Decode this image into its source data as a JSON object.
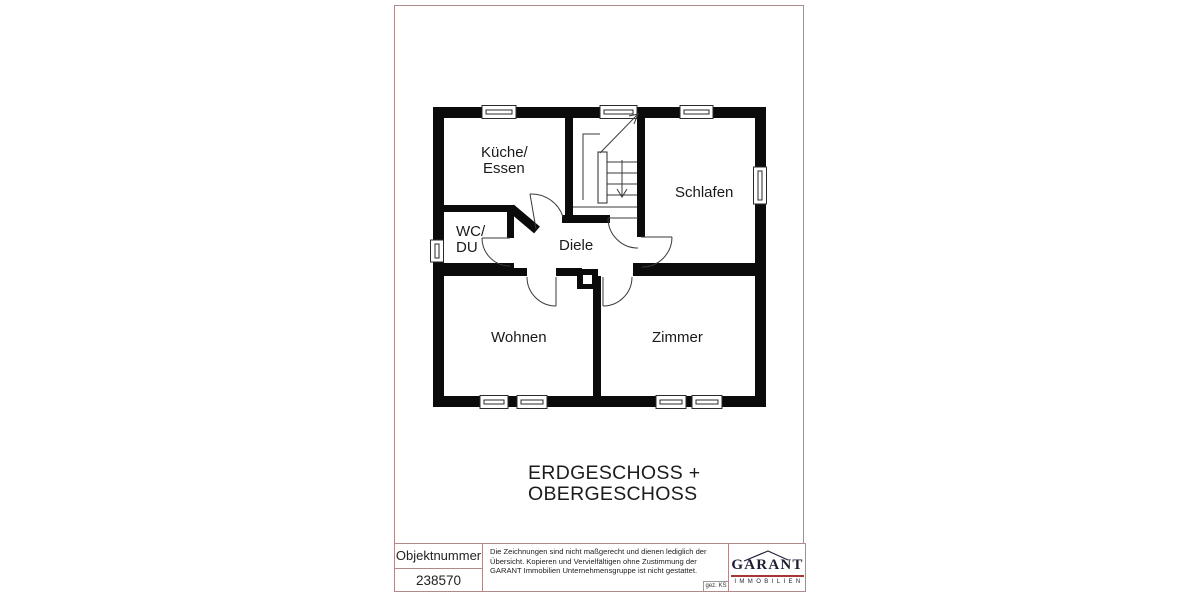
{
  "plan": {
    "rooms": {
      "kueche": {
        "line1": "Küche/",
        "line2": "Essen"
      },
      "schlafen": {
        "label": "Schlafen"
      },
      "wc": {
        "line1": "WC/",
        "line2": "DU"
      },
      "diele": {
        "label": "Diele"
      },
      "wohnen": {
        "label": "Wohnen"
      },
      "zimmer": {
        "label": "Zimmer"
      }
    }
  },
  "title": {
    "line1": "ERDGESCHOSS +",
    "line2": "OBERGESCHOSS"
  },
  "footer": {
    "object_number_label": "Objektnummer",
    "object_number_value": "238570",
    "disclaimer": "Die Zeichnungen sind nicht maßgerecht und dienen lediglich der Übersicht. Kopieren und Vervielfältigen ohne Zustimmung der GARANT Immobilien Unternehmensgruppe ist nicht gestattet.",
    "signature": "gez. KS",
    "logo": {
      "name": "GARANT",
      "subtitle": "IMMOBILIEN"
    }
  },
  "colors": {
    "frame": "#b08a8a",
    "wall": "#0b0b0b",
    "logo_red": "#a83636",
    "logo_navy": "#1e1e34"
  }
}
